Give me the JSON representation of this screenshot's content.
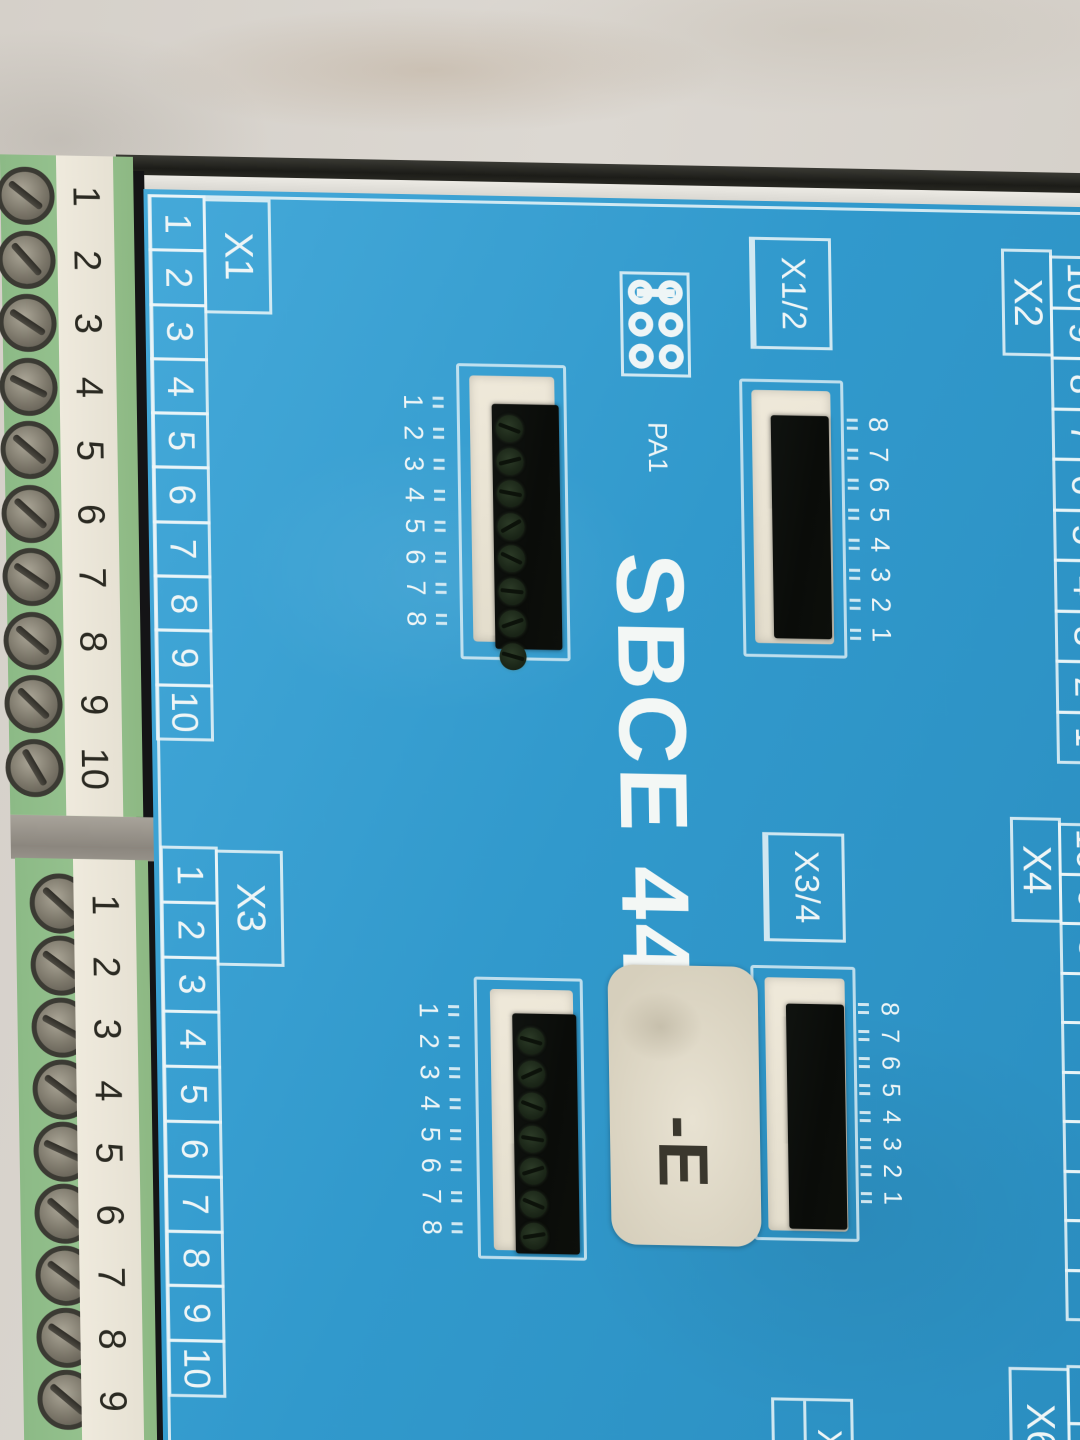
{
  "device": {
    "title": "SBCE 44",
    "sticker_suffix": "-E"
  },
  "colors": {
    "panel_blue": "#3aa2d3",
    "print_white": "#eef5f6",
    "terminal_green": "#92bf8c",
    "strip_cream": "#ece7da",
    "socket_black": "#0c0e0b",
    "bezel_cream": "#ebe5d6",
    "sticker_cream": "#dcd5c3",
    "marble_background": "#d8d3cc"
  },
  "terminals": {
    "block1_numbers": [
      "1",
      "2",
      "3",
      "4",
      "5",
      "6",
      "7",
      "8",
      "9",
      "10"
    ],
    "block1_screw_angles": [
      38,
      48,
      33,
      26,
      40,
      42,
      34,
      40,
      44,
      60
    ],
    "block2_numbers": [
      "1",
      "2",
      "3",
      "4",
      "5",
      "6",
      "7",
      "8",
      "9"
    ],
    "block2_screw_angles": [
      42,
      36,
      28,
      36,
      24,
      40,
      36,
      34,
      40
    ]
  },
  "panel": {
    "x1": {
      "label": "X1",
      "cells": [
        "1",
        "2",
        "3",
        "4",
        "5",
        "6",
        "7",
        "8",
        "9",
        "10"
      ]
    },
    "x2": {
      "label": "X2",
      "cells": [
        "10",
        "9",
        "8",
        "7",
        "6",
        "5",
        "4",
        "3",
        "2",
        "1"
      ]
    },
    "x3": {
      "label": "X3",
      "cells": [
        "1",
        "2",
        "3",
        "4",
        "5",
        "6",
        "7",
        "8",
        "9",
        "10"
      ]
    },
    "x4": {
      "label": "X4",
      "cells": [
        "10",
        "9",
        "8",
        "7",
        "6",
        "5",
        "4",
        "3",
        "2",
        "1"
      ]
    },
    "x6": {
      "label": "X6",
      "cells": [
        "10",
        "9"
      ]
    },
    "x12_box": {
      "label": "X1/2"
    },
    "x34_box": {
      "label": "X3/4"
    },
    "x5_box": {
      "label": "X5"
    },
    "pa1": {
      "label": "PA1",
      "pins": [
        1,
        2,
        3,
        4,
        5,
        6
      ]
    },
    "connA": {
      "pin_labels": [
        "1",
        "2",
        "3",
        "4",
        "5",
        "6",
        "7",
        "8"
      ],
      "socket_screws": [
        20,
        -15,
        10,
        -30,
        25,
        5,
        -20,
        15
      ]
    },
    "connB": {
      "pin_labels": [
        "8",
        "7",
        "6",
        "5",
        "4",
        "3",
        "2",
        "1"
      ]
    },
    "connC": {
      "pin_labels": [
        "1",
        "2",
        "3",
        "4",
        "5",
        "6",
        "7",
        "8"
      ],
      "socket_screws": [
        15,
        -25,
        20,
        8,
        -18,
        22,
        -10
      ]
    },
    "connD": {
      "pin_labels": [
        "8",
        "7",
        "6",
        "5",
        "4",
        "3",
        "2",
        "1"
      ]
    }
  }
}
